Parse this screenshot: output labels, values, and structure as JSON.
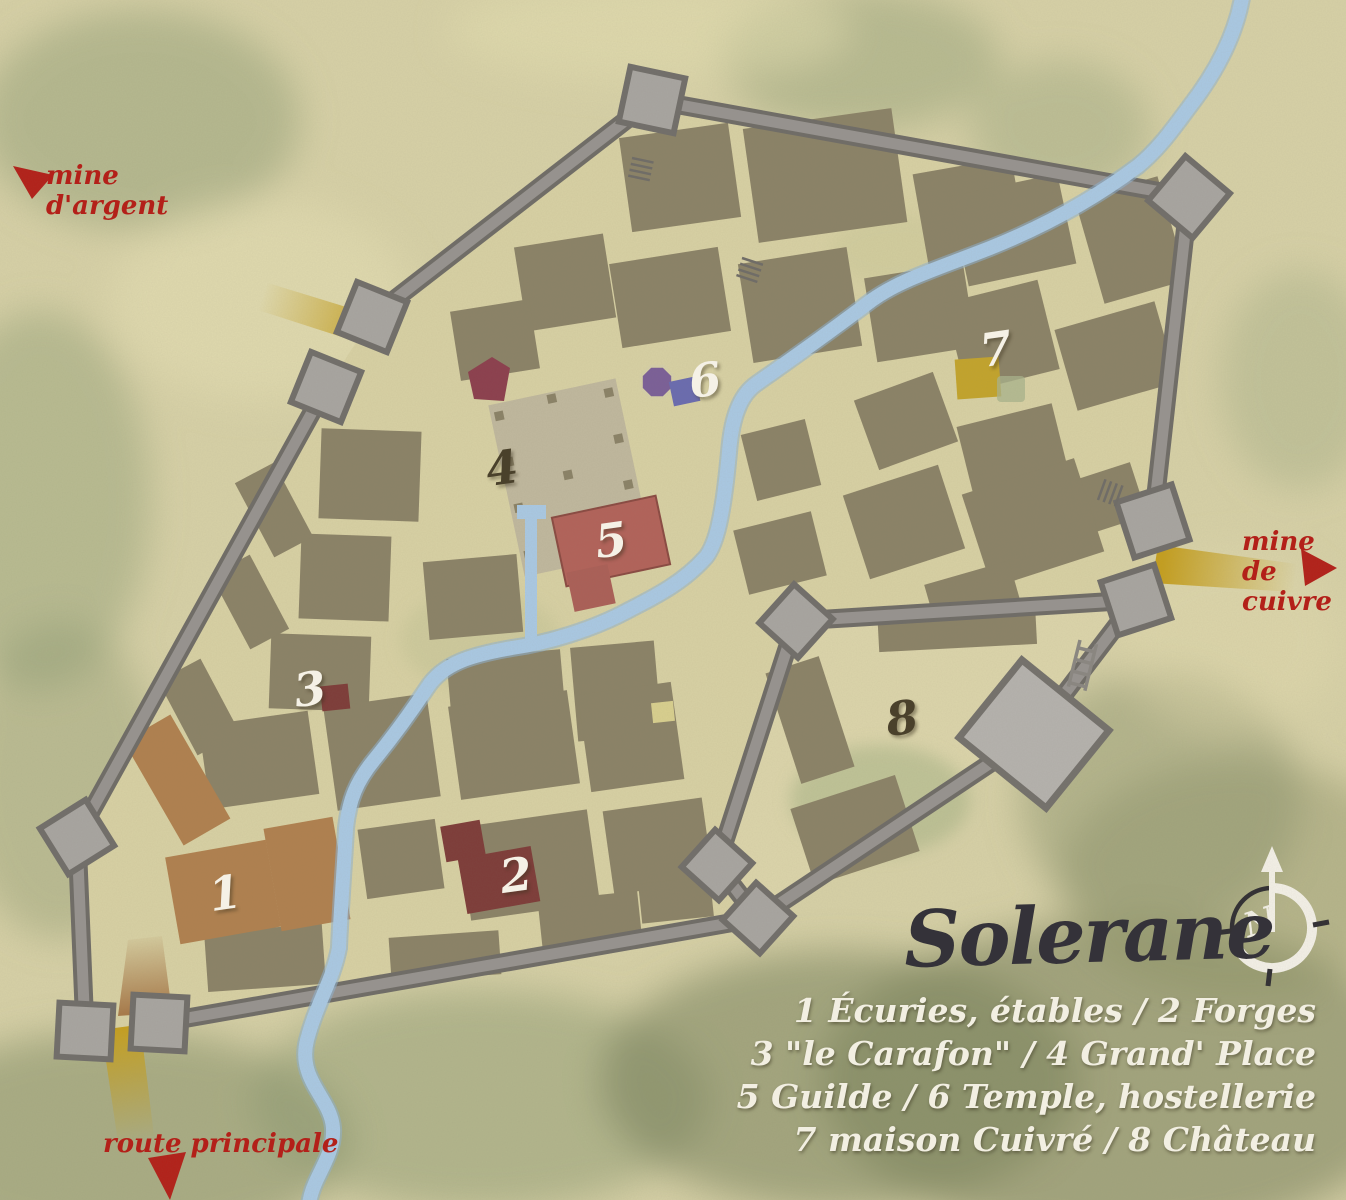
{
  "title": "Solerane",
  "legend": {
    "lines": [
      "1 Écuries, étables / 2 Forges",
      "3 \"le Carafon\" / 4 Grand' Place",
      "5 Guilde / 6 Temple, hostellerie",
      "7 maison Cuivré / 8 Château"
    ]
  },
  "direction_labels": [
    {
      "id": "silver-mine",
      "lines": [
        "mine",
        "d'argent"
      ],
      "arrow": "up-left"
    },
    {
      "id": "copper-mine",
      "lines": [
        "mine de",
        "cuivre"
      ],
      "arrow": "right"
    },
    {
      "id": "main-road",
      "lines": [
        "route principale"
      ],
      "arrow": "down"
    }
  ],
  "markers": [
    {
      "num": "1",
      "name": "Écuries, étables",
      "x": 16.7,
      "y": 74.4,
      "color": "#f5f1e6"
    },
    {
      "num": "2",
      "name": "Forges",
      "x": 38.3,
      "y": 72.9,
      "color": "#f5f1e6"
    },
    {
      "num": "3",
      "name": "le Carafon",
      "x": 23.0,
      "y": 57.4,
      "color": "#f5f1e6"
    },
    {
      "num": "4",
      "name": "Grand' Place",
      "x": 37.3,
      "y": 39.0,
      "color": "#4a412b"
    },
    {
      "num": "5",
      "name": "Guilde",
      "x": 45.4,
      "y": 45.0,
      "color": "#f5f1e6"
    },
    {
      "num": "6",
      "name": "Temple, hostellerie",
      "x": 52.4,
      "y": 31.7,
      "color": "#f5f1e6"
    },
    {
      "num": "7",
      "name": "maison Cuivré",
      "x": 74.0,
      "y": 29.1,
      "color": "#f5f1e6"
    },
    {
      "num": "8",
      "name": "Château",
      "x": 67.0,
      "y": 59.8,
      "color": "#4a412b"
    }
  ],
  "compass": {
    "letter": "N"
  },
  "colors": {
    "parchment": "#d7d1a7",
    "street": "#d8d1a4",
    "building": "#8b8267",
    "wall": "#979390",
    "river": "#aac9e4",
    "road_gold": "#c59f1f",
    "label_red": "#b32019",
    "stables_brown": "#b0804f",
    "forge_red": "#7e3c39",
    "plaza": "#c0b89e",
    "guild_red": "#b2625a",
    "temple_purple": "#7b5f98",
    "hostel_blue": "#6a6bb0",
    "cuivre_gold": "#c3a42c",
    "keep_grey": "#b5b2ae"
  }
}
